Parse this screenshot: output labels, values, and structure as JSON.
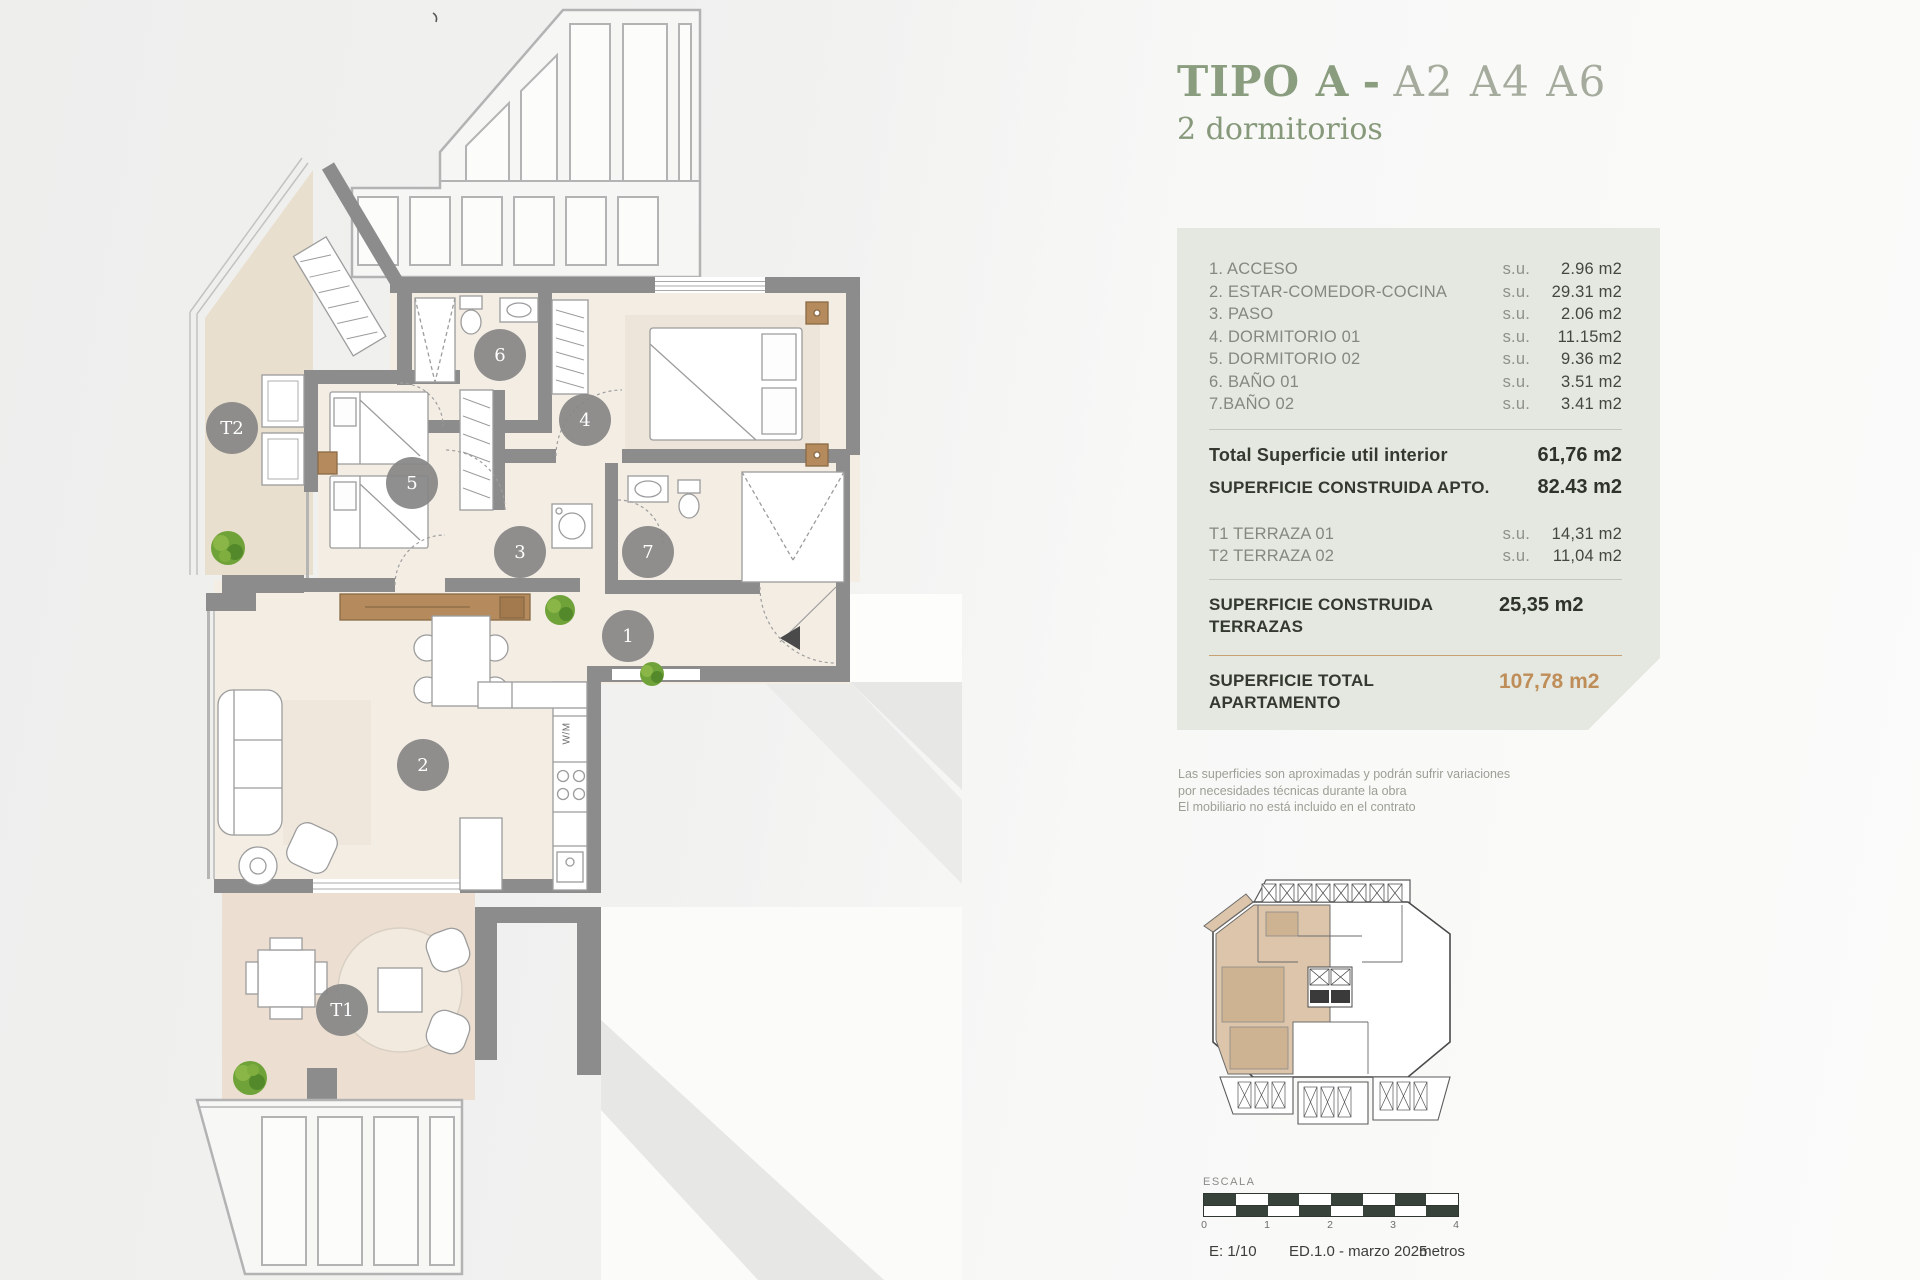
{
  "title": {
    "type_label": "TIPO A",
    "separator": "-",
    "units": "A2 A4 A6",
    "subtitle": "2 dormitorios"
  },
  "areas_panel": {
    "rooms": [
      {
        "label": "1. ACCESO",
        "unit": "s.u.",
        "value": "2.96 m2"
      },
      {
        "label": "2. ESTAR-COMEDOR-COCINA",
        "unit": "s.u.",
        "value": "29.31 m2"
      },
      {
        "label": "3. PASO",
        "unit": "s.u.",
        "value": "2.06 m2"
      },
      {
        "label": "4. DORMITORIO 01",
        "unit": "s.u.",
        "value": "11.15m2"
      },
      {
        "label": "5. DORMITORIO 02",
        "unit": "s.u.",
        "value": "9.36 m2"
      },
      {
        "label": "6. BAÑO 01",
        "unit": "s.u.",
        "value": "3.51 m2"
      },
      {
        "label": "7.BAÑO 02",
        "unit": "s.u.",
        "value": "3.41 m2"
      }
    ],
    "total_interior": {
      "label": "Total Superficie util interior",
      "value": "61,76 m2"
    },
    "total_construida": {
      "label": "SUPERFICIE CONSTRUIDA APTO.",
      "value": "82.43 m2"
    },
    "terraces": [
      {
        "label": "T1 TERRAZA 01",
        "unit": "s.u.",
        "value": "14,31 m2"
      },
      {
        "label": "T2 TERRAZA 02",
        "unit": "s.u.",
        "value": "11,04 m2"
      }
    ],
    "terraces_total": {
      "label": "SUPERFICIE CONSTRUIDA TERRAZAS",
      "value": "25,35 m2"
    },
    "grand_total": {
      "label": "SUPERFICIE TOTAL APARTAMENTO",
      "value": "107,78 m2"
    }
  },
  "disclaimer": {
    "line1": "Las superficies son aproximadas y podrán sufrir variaciones",
    "line2": "por necesidades técnicas durante la obra",
    "line3": "El mobiliario no está incluido en el contrato"
  },
  "scale_bar": {
    "label": "ESCALA",
    "ticks": [
      "0",
      "1",
      "2",
      "3",
      "4"
    ],
    "scale": "E: 1/10",
    "edition": "ED.1.0 - marzo 2025",
    "units_label": "metros"
  },
  "floor_plan": {
    "markers": {
      "t2": "T2",
      "d5": "5",
      "b6": "6",
      "d4": "4",
      "p3": "3",
      "b7": "7",
      "a1": "1",
      "e2": "2",
      "t1": "T1"
    },
    "kitchen_appliance_label": "W/M"
  },
  "colors": {
    "accent_green": "#8a9d7e",
    "accent_green_light": "#a6ac9d",
    "accent_tan": "#bf8d58",
    "panel_bg": "#e5e8e1",
    "wall_gray": "#8c8c8c",
    "terrace_beige": "#e9dfce",
    "terrace_t1": "#ecdfd1",
    "interior_cream": "#f3ede4",
    "marker_gray": "#868686",
    "plant_green": "#6fa238",
    "scale_dark": "#36423a"
  }
}
